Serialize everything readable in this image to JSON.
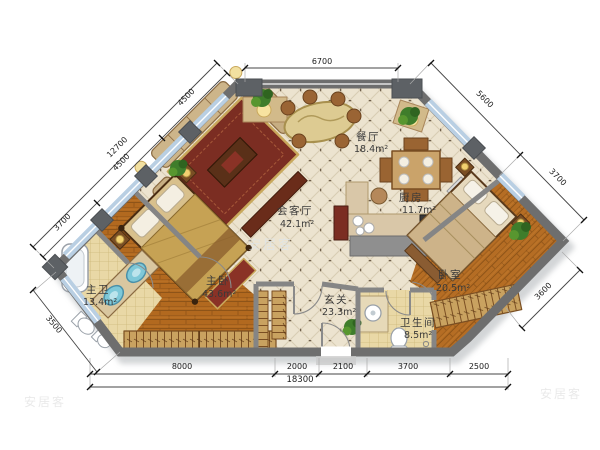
{
  "plan": {
    "type": "apartment-floor-plan",
    "watermark": "安居客",
    "rooms": [
      {
        "name": "餐厅",
        "area": "18.4m²"
      },
      {
        "name": "厨房",
        "area": "11.7m²"
      },
      {
        "name": "会客厅",
        "area": "42.1m²"
      },
      {
        "name": "主卧",
        "area": "43.6m²"
      },
      {
        "name": "主卫",
        "area": "13.4m²"
      },
      {
        "name": "卧室",
        "area": "20.5m²"
      },
      {
        "name": "玄关",
        "area": "23.3m²"
      },
      {
        "name": "卫生间",
        "area": "8.5m²"
      }
    ],
    "dimensions": {
      "top": "6700",
      "right_upper": [
        "5600",
        "3700"
      ],
      "right_lower": "3600",
      "left_outer_total": "12700",
      "left_inner": [
        "4500",
        "4500",
        "3700"
      ],
      "left_lower": "3500",
      "bottom": [
        "8000",
        "2000",
        "2100",
        "3700",
        "2500"
      ],
      "bottom_total": "18300"
    },
    "colors": {
      "wall": "#6e6e6e",
      "window_band": "#b9cfe3",
      "tile_floor": "#ece3cf",
      "wood_floor": "#b2691f",
      "bath_tile": "#e9d8a6",
      "wardrobe": "#c9a260"
    }
  }
}
